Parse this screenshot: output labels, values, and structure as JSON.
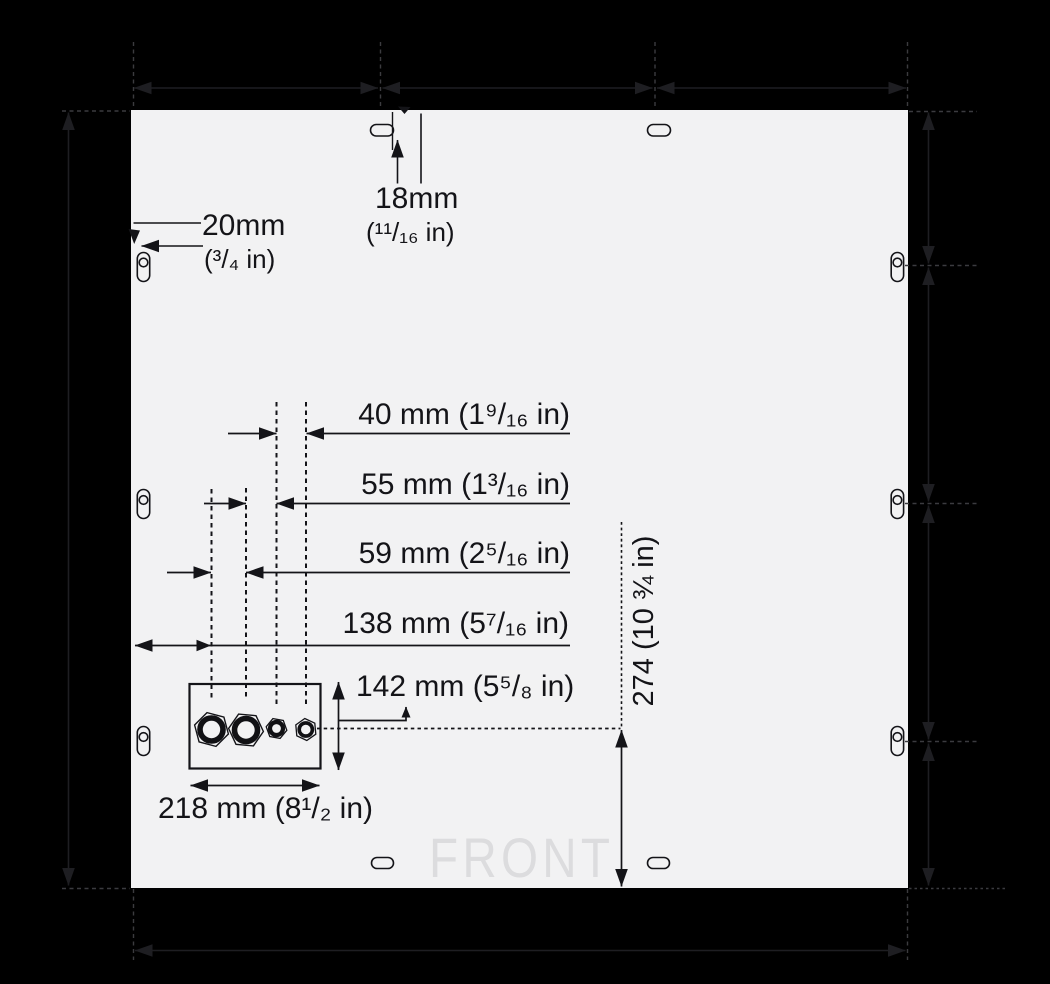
{
  "drawing": {
    "description": "Enclosure back-panel mounting and knockout dimension drawing",
    "front_marking": "FRONT",
    "colors": {
      "panel_fill": "#f2f2f3",
      "line": "#141418",
      "margin_line": "#1e1e22",
      "margin_dash": "#3b3b3f",
      "front_text": "#dcdcde"
    }
  },
  "dimensions": {
    "slot_edge_offset": {
      "value_mm": 20,
      "mm_label": "20mm",
      "in_label": "(³/₄ in)"
    },
    "slot_top_offset": {
      "value_mm": 18,
      "mm_label": "18mm",
      "in_label": "(¹¹/₁₆ in)"
    },
    "knockout_spacing_3_4": {
      "value_mm": 40,
      "label": "40 mm (1⁹/₁₆ in)"
    },
    "knockout_spacing_2_3": {
      "value_mm": 55,
      "label": "55 mm (1³/₁₆ in)"
    },
    "knockout_spacing_1_2": {
      "value_mm": 59,
      "label": "59 mm (2⁵/₁₆ in)"
    },
    "knockout_edge_offset": {
      "value_mm": 138,
      "label": "138 mm (5⁷/₁₆ in)"
    },
    "knockout_box_height": {
      "value_mm": 142,
      "label": "142 mm (5⁵/₈ in)"
    },
    "knockout_box_width": {
      "value_mm": 218,
      "label": "218 mm (8¹/₂ in)"
    },
    "knockout_center_to_bottom": {
      "value_mm": 274,
      "label": "274 (10 ¾ in)"
    }
  }
}
